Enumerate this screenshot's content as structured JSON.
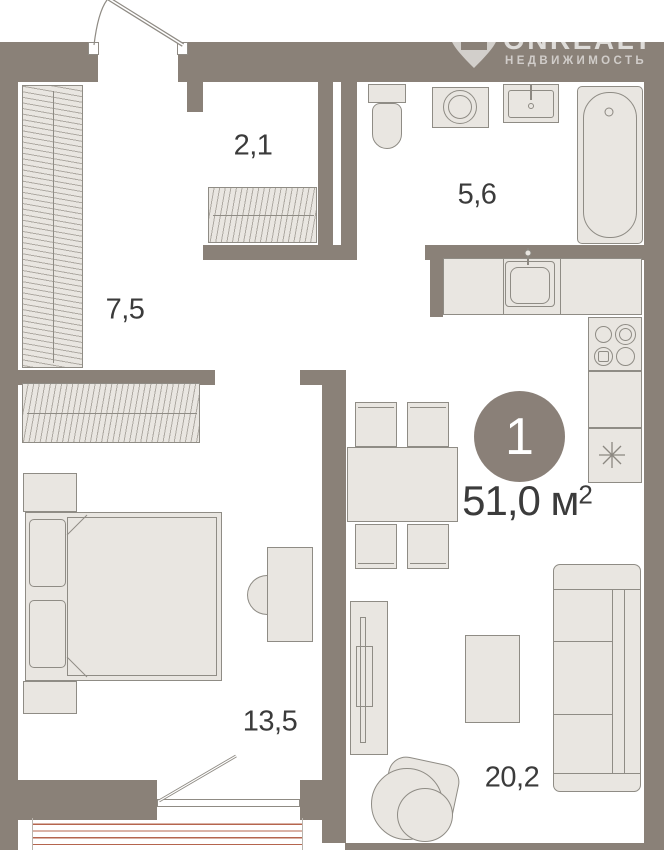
{
  "watermark": {
    "brand": "ONREALT",
    "subtitle": "НЕДВИЖИМОСТЬ",
    "logo_icon": "map-pin-house-icon"
  },
  "badge": {
    "rooms_count": "1"
  },
  "area": {
    "value": "51,0",
    "unit": "м",
    "sup": "2"
  },
  "rooms": {
    "closet": {
      "label": "2,1"
    },
    "bathroom": {
      "label": "5,6"
    },
    "hallway": {
      "label": "7,5"
    },
    "bedroom": {
      "label": "13,5"
    },
    "living": {
      "label": "20,2"
    },
    "balcony": {
      "label": "3,6"
    }
  },
  "colors": {
    "wall": "#8a8178",
    "furniture_fill": "#e9e6e1",
    "furniture_stroke": "#8f8c85",
    "detail_stroke": "#8f8b84",
    "balcony_stripe": "#b5654e",
    "badge_bg": "#8a8078",
    "text": "#3b3b3b"
  }
}
